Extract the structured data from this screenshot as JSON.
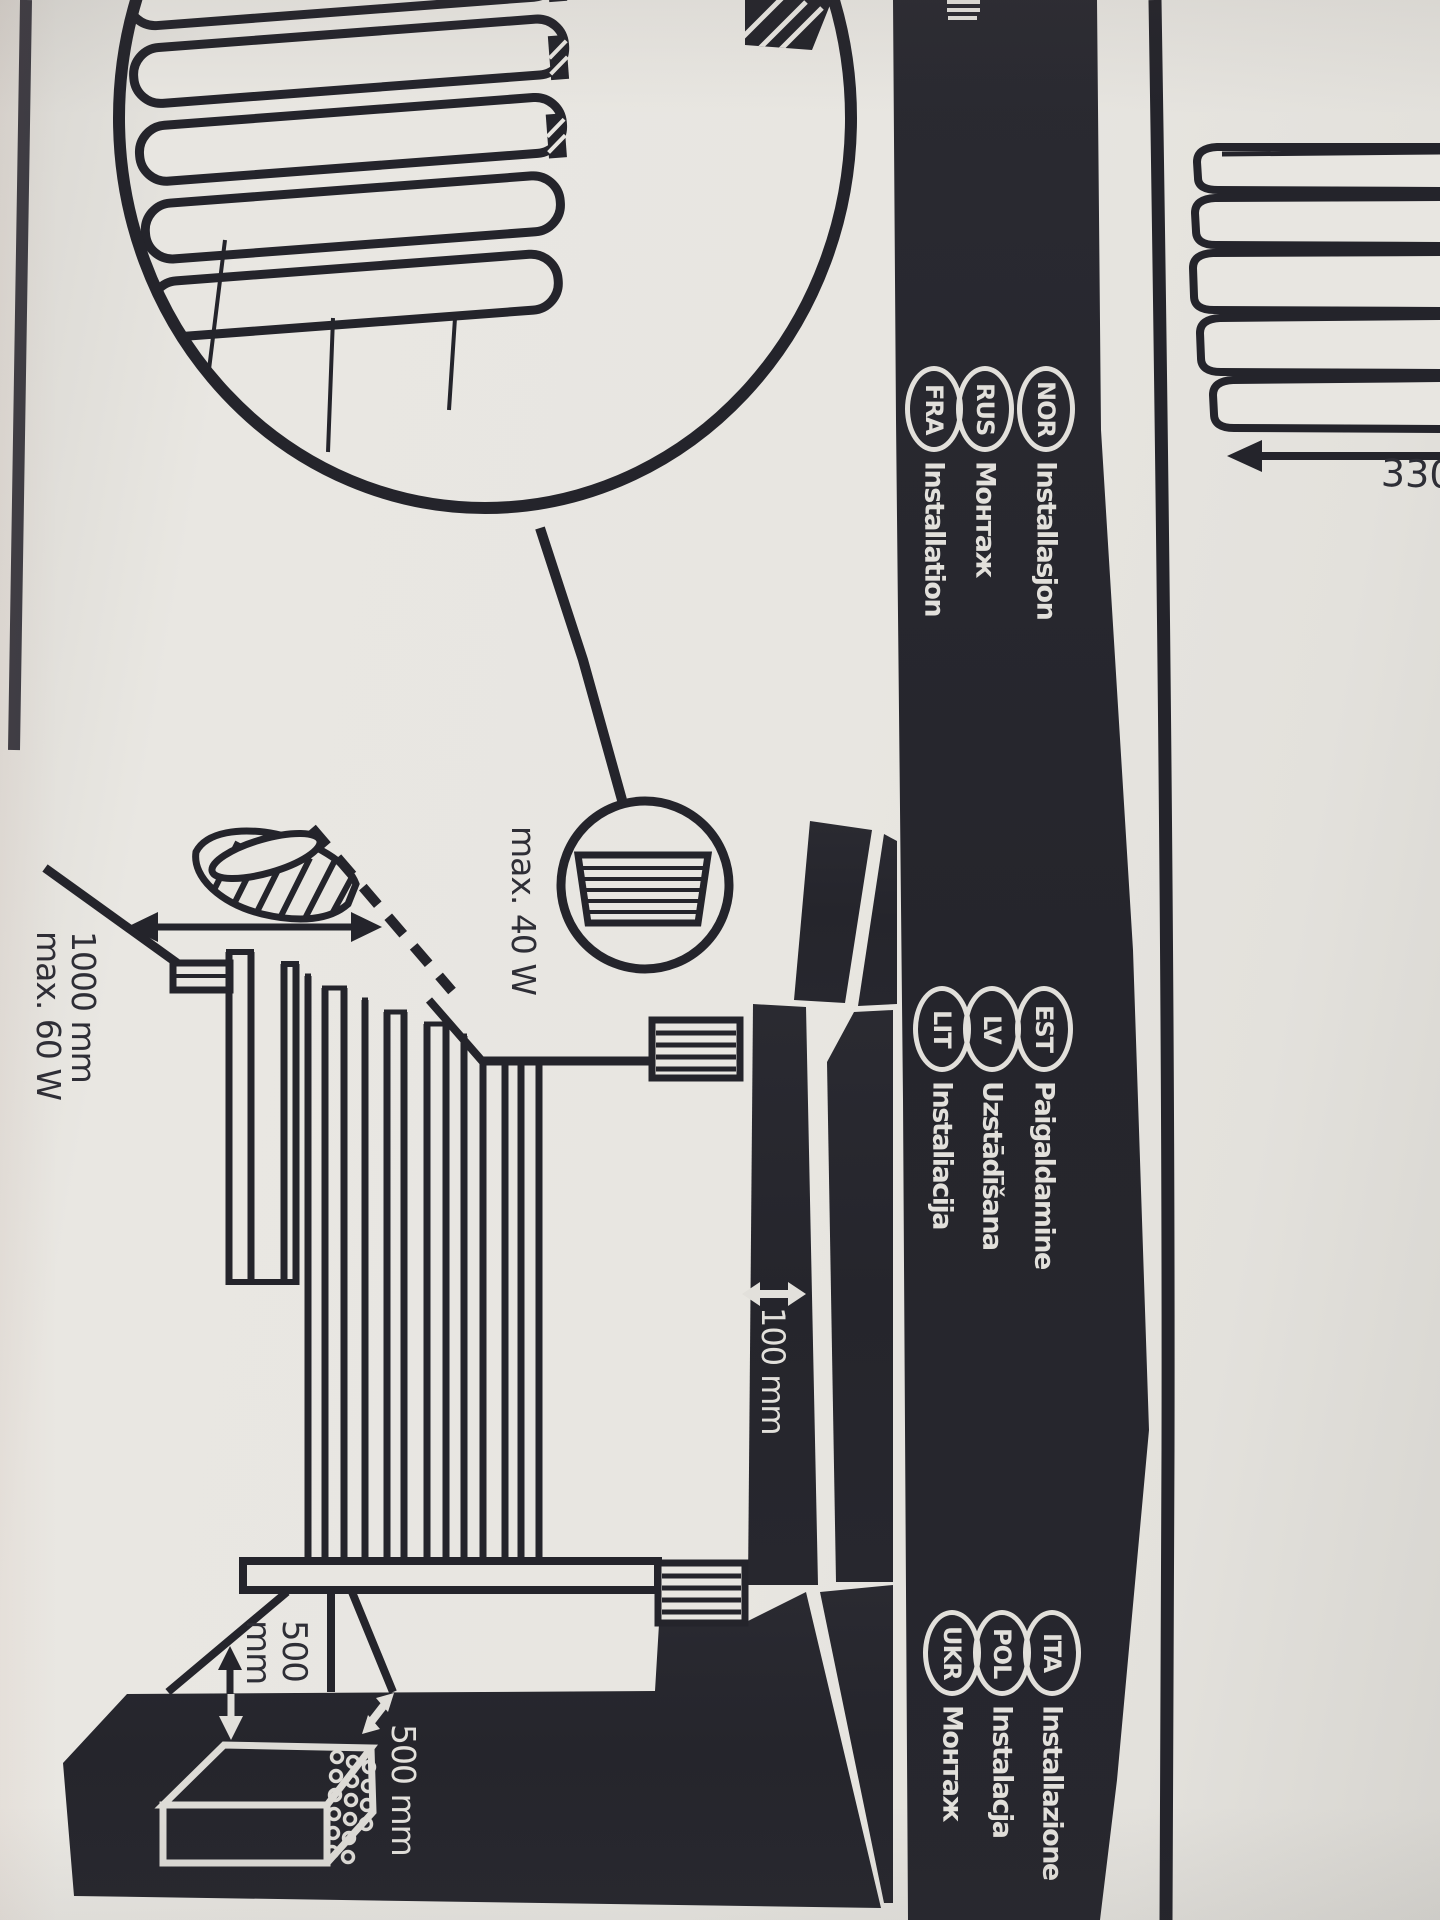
{
  "colors": {
    "paper": "#e8e6e1",
    "ink": "#24242b",
    "band_fill": "#26262d",
    "print_white": "#e2e0db"
  },
  "band": {
    "groups": [
      {
        "items": [
          {
            "code": "NOR",
            "label": "Installasjon"
          },
          {
            "code": "RUS",
            "label": "Монтаж"
          },
          {
            "code": "FRA",
            "label": "Installation"
          }
        ]
      },
      {
        "items": [
          {
            "code": "EST",
            "label": "Paigaldamine"
          },
          {
            "code": "LV",
            "label": "Uzstādīšana"
          },
          {
            "code": "LIT",
            "label": "Instaliacija"
          }
        ]
      },
      {
        "items": [
          {
            "code": "ITA",
            "label": "Installazione"
          },
          {
            "code": "POL",
            "label": "Instalacja"
          },
          {
            "code": "UKR",
            "label": "Монтаж"
          }
        ]
      }
    ]
  },
  "dimensions": {
    "shade_max_wattage": "max. 40 W",
    "uplight_distance": "1000 mm",
    "uplight_max_wattage": "max. 60 W",
    "wall_clearance": "100 mm",
    "driver_clearance_vertical_value": "500",
    "driver_clearance_vertical_unit": "mm",
    "driver_clearance_horizontal": "500 mm",
    "adjacent_panel_dimension": "330"
  }
}
